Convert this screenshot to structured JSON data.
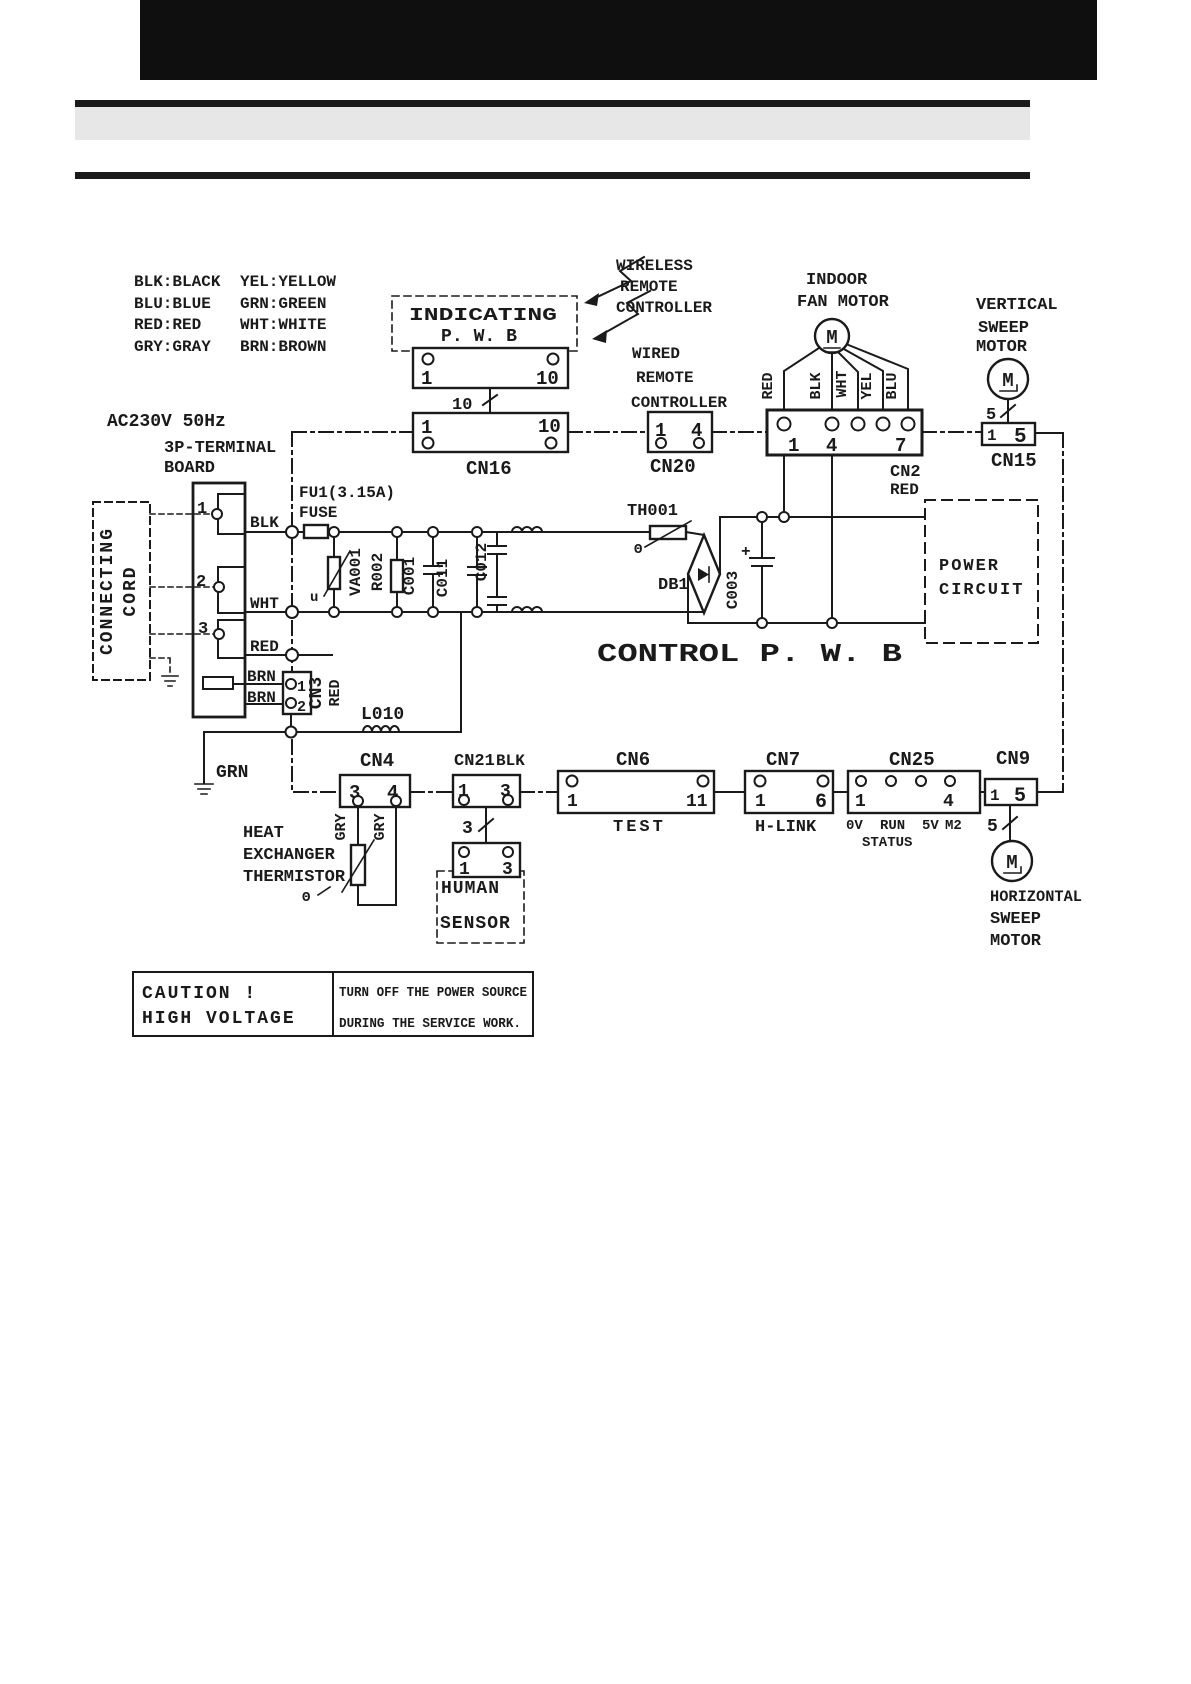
{
  "colors": {
    "ink": "#1a1a1a",
    "paper": "#ffffff",
    "band": "#e7e7e7",
    "header": "#0f0f0f"
  },
  "legend": {
    "col1": [
      "BLK:BLACK",
      "BLU:BLUE",
      "RED:RED",
      "GRY:GRAY"
    ],
    "col2": [
      "YEL:YELLOW",
      "GRN:GREEN",
      "WHT:WHITE",
      "BRN:BROWN"
    ]
  },
  "mains": {
    "ac": "AC230V 50Hz",
    "board1": "3P-TERMINAL",
    "board2": "BOARD",
    "terminals": [
      "1",
      "2",
      "3"
    ],
    "cord1": "CONNECTING",
    "cord2": "CORD",
    "fuse1": "FU1(3.15A)",
    "fuse2": "FUSE"
  },
  "wires": {
    "blk": "BLK",
    "wht": "WHT",
    "red": "RED",
    "brn1": "BRN",
    "brn2": "BRN",
    "grn": "GRN",
    "gry1": "GRY",
    "gry2": "GRY",
    "fan": [
      "RED",
      "BLK",
      "WHT",
      "YEL",
      "BLU"
    ]
  },
  "components": {
    "va001": "VA001",
    "r002": "R002",
    "c001": "C001",
    "c011": "C011",
    "c012": "C012",
    "l010": "L010",
    "th001": "TH001",
    "db1": "DB1",
    "c003": "C003",
    "plus": "+",
    "u": "u",
    "theta1": "Θ",
    "theta2": "Θ"
  },
  "blocks": {
    "indicating1": "INDICATING",
    "indicating2": "P. W. B",
    "wireless": [
      "WIRELESS",
      "REMOTE",
      "CONTROLLER"
    ],
    "wired": [
      "WIRED",
      "REMOTE",
      "CONTROLLER"
    ],
    "indoor_fan": [
      "INDOOR",
      "FAN MOTOR"
    ],
    "vertical": [
      "VERTICAL",
      "SWEEP",
      "MOTOR"
    ],
    "horizontal": [
      "HORIZONTAL",
      "SWEEP",
      "MOTOR"
    ],
    "power_circuit": [
      "POWER",
      "CIRCUIT"
    ],
    "control_pwb": "CONTROL P. W. B",
    "heat_exch": [
      "HEAT",
      "EXCHANGER",
      "THERMISTOR"
    ],
    "human": [
      "HUMAN",
      "SENSOR"
    ],
    "motor": "M"
  },
  "connectors": {
    "ind_conn": {
      "p1": "1",
      "p2": "10"
    },
    "bundle10": "10",
    "cn16": {
      "label": "CN16",
      "p1": "1",
      "p2": "10"
    },
    "cn20": {
      "label": "CN20",
      "p1": "1",
      "p2": "4"
    },
    "cn2": {
      "label": "CN2",
      "color": "RED",
      "p1": "1",
      "p2": "4",
      "p3": "7"
    },
    "cn15": {
      "label": "CN15",
      "p1": "1",
      "p2": "5",
      "bundle": "5"
    },
    "cn3": {
      "label": "CN3",
      "color": "RED",
      "p1": "1",
      "p2": "2"
    },
    "cn4": {
      "label": "CN4",
      "p1": "3",
      "p2": "4"
    },
    "cn21": {
      "label": "CN21",
      "color": "BLK",
      "p1": "1",
      "p2": "3",
      "bundle": "3"
    },
    "human_conn": {
      "p1": "1",
      "p2": "3"
    },
    "cn6": {
      "label": "CN6",
      "p1": "1",
      "p2": "11",
      "sub": "TEST"
    },
    "cn7": {
      "label": "CN7",
      "p1": "1",
      "p2": "6",
      "sub": "H-LINK"
    },
    "cn25": {
      "label": "CN25",
      "p1": "1",
      "p2": "4",
      "s1": "0V",
      "s2": "RUN",
      "s3": "5V",
      "s4": "M2",
      "s5": "STATUS"
    },
    "cn9": {
      "label": "CN9",
      "p1": "1",
      "p2": "5",
      "bundle": "5"
    }
  },
  "caution": {
    "l1": "CAUTION !",
    "l2": "HIGH VOLTAGE",
    "r1": "TURN OFF THE POWER SOURCE",
    "r2": "DURING THE SERVICE WORK."
  }
}
